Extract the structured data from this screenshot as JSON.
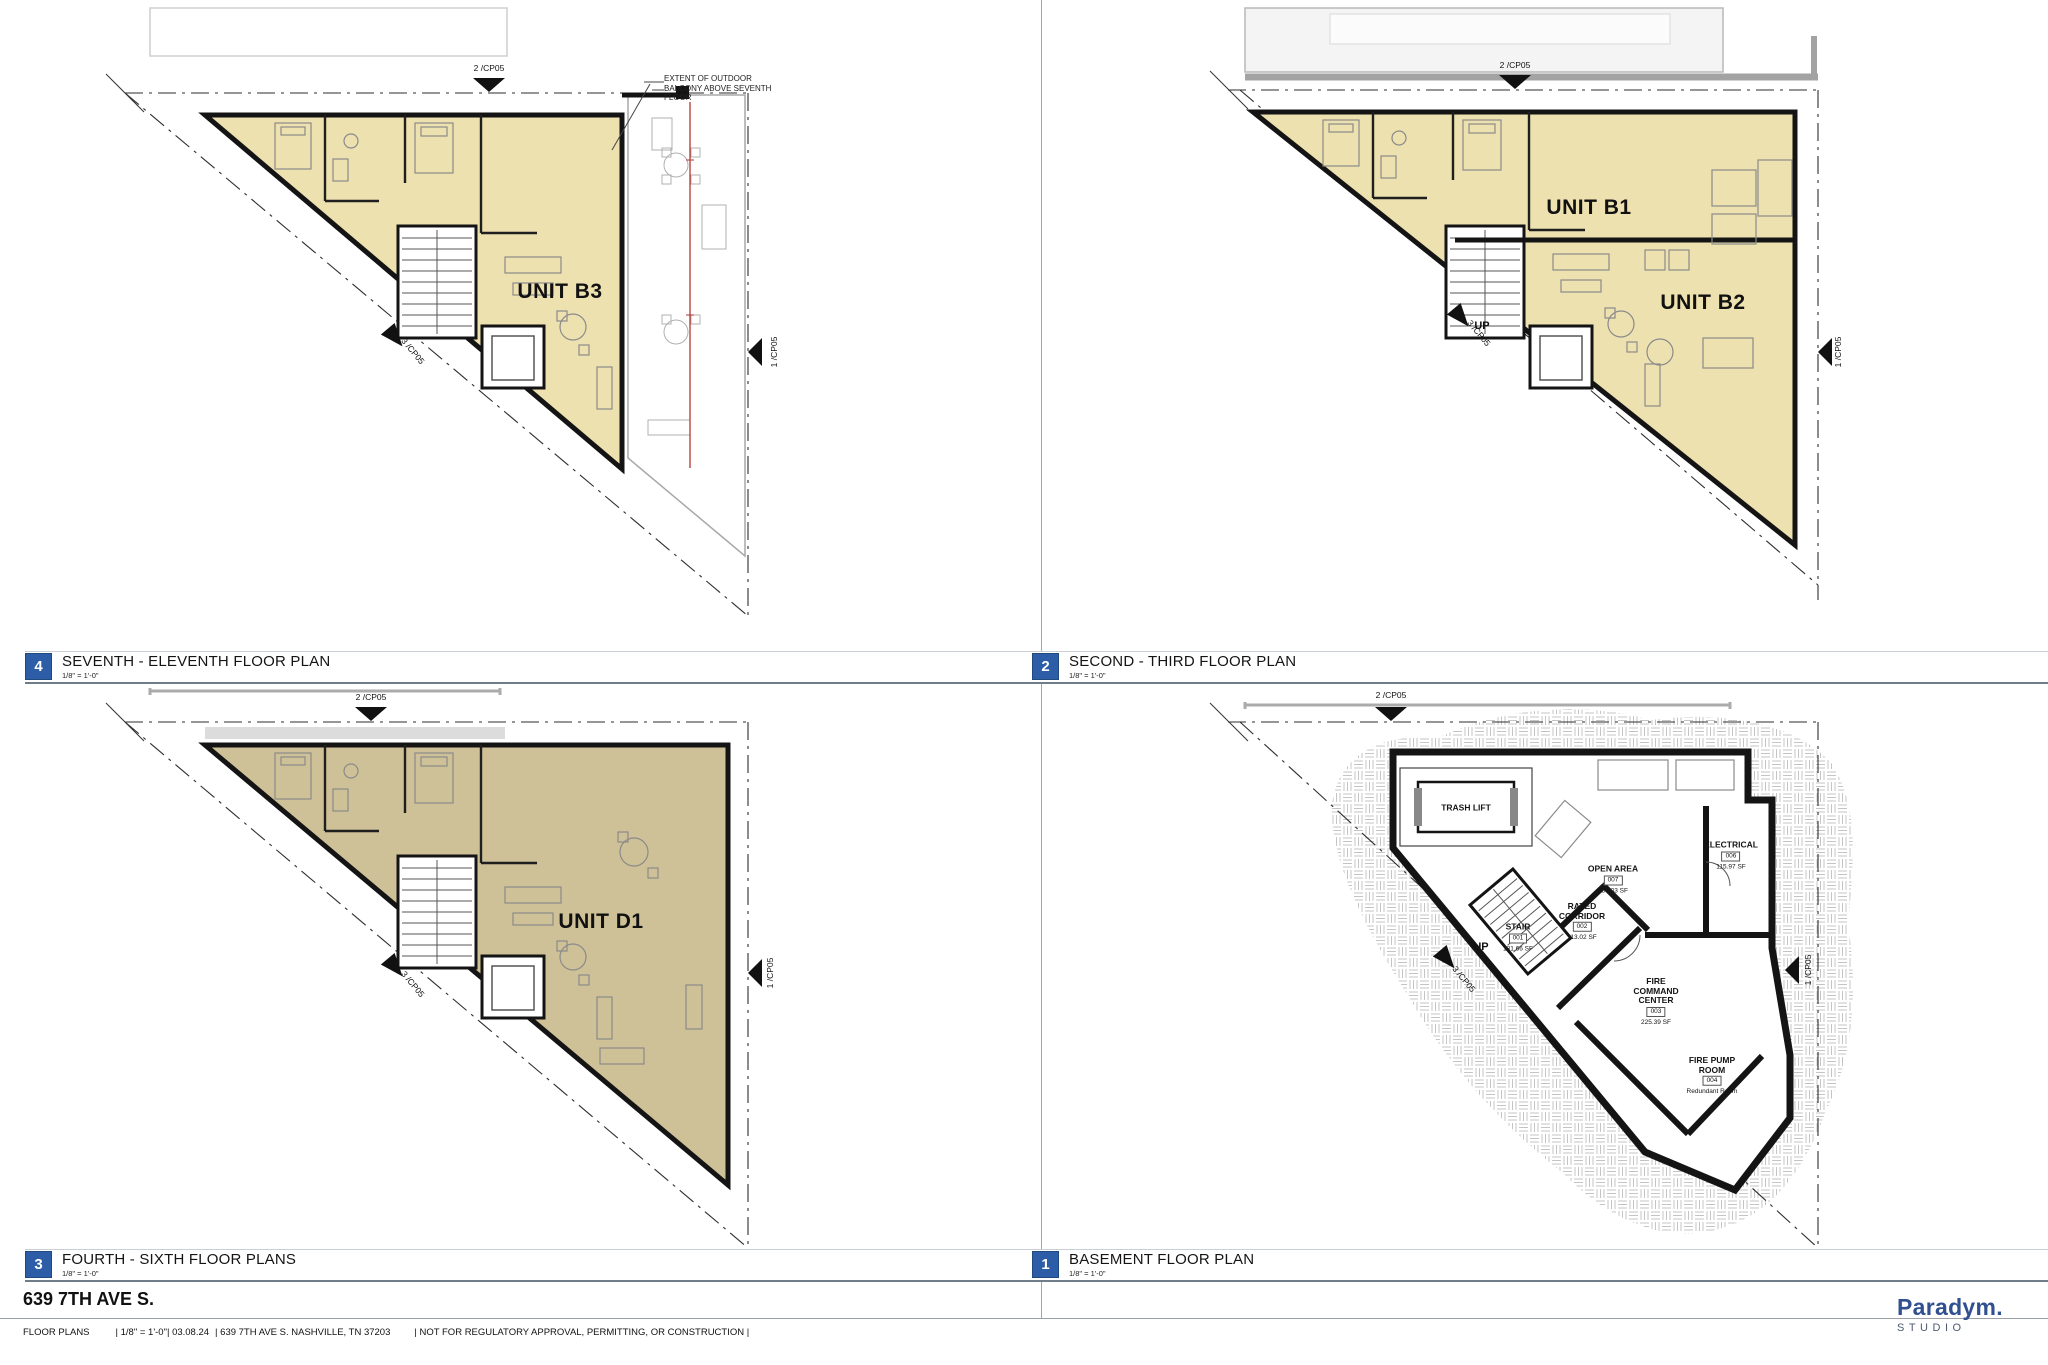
{
  "sheet": {
    "project_title": "639 7TH AVE S.",
    "footer_items": [
      "FLOOR PLANS",
      "| 1/8\" = 1'-0\"| 03.08.24",
      "| 639 7TH AVE S. NASHVILLE, TN 37203",
      "| NOT FOR REGULATORY APPROVAL, PERMITTING, OR CONSTRUCTION |"
    ],
    "logo_name": "Paradym.",
    "logo_sub": "STUDIO"
  },
  "markers": {
    "top": "2 /CP05",
    "right": "1 /CP05",
    "diagonal": "3 /CP05"
  },
  "panels": {
    "seventh": {
      "number": "4",
      "title": "SEVENTH - ELEVENTH FLOOR PLAN",
      "scale": "1/8\" = 1'-0\"",
      "unit": "UNIT B3",
      "note": "EXTENT OF OUTDOOR\nBALCONY ABOVE SEVENTH\nFLOOR"
    },
    "second": {
      "number": "2",
      "title": "SECOND - THIRD FLOOR PLAN",
      "scale": "1/8\" = 1'-0\"",
      "unit_b1": "UNIT B1",
      "unit_b2": "UNIT B2",
      "up": "UP"
    },
    "fourth": {
      "number": "3",
      "title": "FOURTH - SIXTH FLOOR PLANS",
      "scale": "1/8\" = 1'-0\"",
      "unit": "UNIT D1"
    },
    "basement": {
      "number": "1",
      "title": "BASEMENT FLOOR PLAN",
      "scale": "1/8\" = 1'-0\"",
      "rooms": {
        "trash_lift": {
          "name": "TRASH LIFT"
        },
        "open_area": {
          "name": "OPEN AREA",
          "number": "007",
          "area": "656.03 SF"
        },
        "electrical": {
          "name": "ELECTRICAL",
          "number": "006",
          "area": "115.97 SF"
        },
        "rated_corridor": {
          "name": "RATED\nCORRIDOR",
          "number": "002",
          "area": "113.02 SF"
        },
        "stair": {
          "name": "STAIR",
          "number": "001",
          "area": "181.66 SF",
          "up": "UP"
        },
        "fire_command": {
          "name": "FIRE\nCOMMAND\nCENTER",
          "number": "003",
          "area": "225.39 SF"
        },
        "fire_pump": {
          "name": "FIRE PUMP\nROOM",
          "number": "004",
          "note": "Redundant Room"
        }
      }
    }
  },
  "colors": {
    "unit_fill_cream": "#eee1b0",
    "unit_fill_tan": "#cfc197",
    "panel_badge_blue": "#2d5da6",
    "logo_navy": "#31508f",
    "extent_line_red": "#b23630",
    "wall_black": "#141414"
  }
}
